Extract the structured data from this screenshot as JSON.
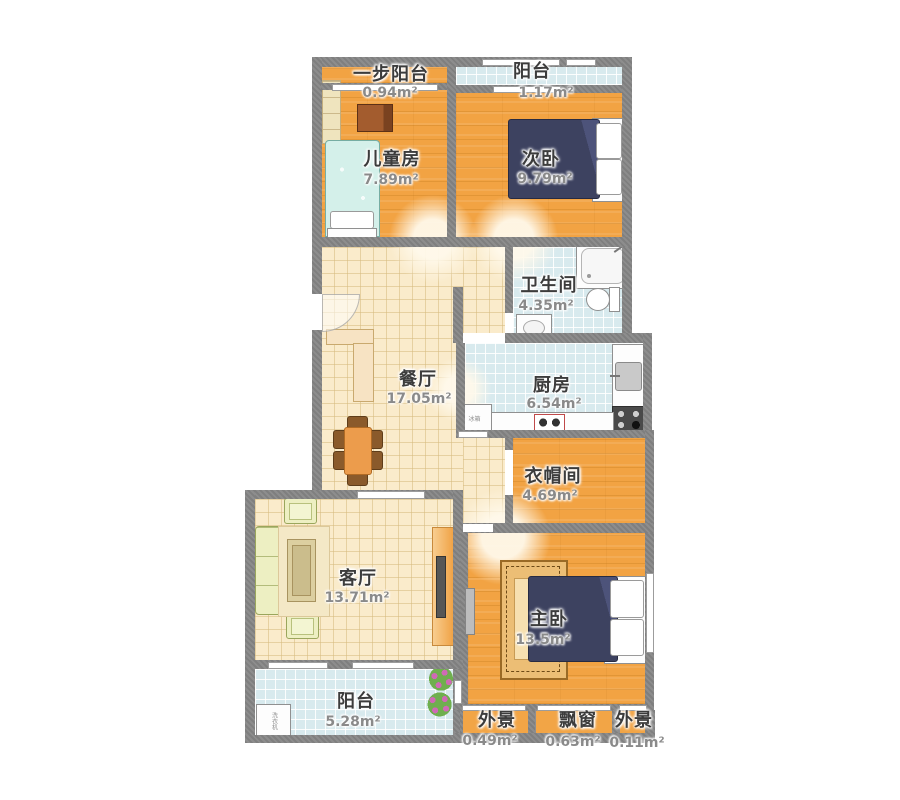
{
  "plan": {
    "rooms": [
      {
        "id": "one-step-balcony",
        "name": "一步阳台",
        "area": "0.94m²"
      },
      {
        "id": "balcony-top",
        "name": "阳台",
        "area": "1.17m²"
      },
      {
        "id": "kids-room",
        "name": "儿童房",
        "area": "7.89m²"
      },
      {
        "id": "second-bedroom",
        "name": "次卧",
        "area": "9.79m²"
      },
      {
        "id": "bathroom",
        "name": "卫生间",
        "area": "4.35m²"
      },
      {
        "id": "dining-room",
        "name": "餐厅",
        "area": "17.05m²"
      },
      {
        "id": "kitchen",
        "name": "厨房",
        "area": "6.54m²"
      },
      {
        "id": "cloakroom",
        "name": "衣帽间",
        "area": "4.69m²"
      },
      {
        "id": "living-room",
        "name": "客厅",
        "area": "13.71m²"
      },
      {
        "id": "master-bedroom",
        "name": "主卧",
        "area": "13.5m²"
      },
      {
        "id": "balcony-bottom",
        "name": "阳台",
        "area": "5.28m²"
      },
      {
        "id": "outer-view-left",
        "name": "外景",
        "area": "0.49m²"
      },
      {
        "id": "bay-window",
        "name": "飘窗",
        "area": "0.63m²"
      },
      {
        "id": "outer-view-right",
        "name": "外景",
        "area": "0.11m²"
      }
    ],
    "appliance_labels": {
      "washing_machine": "洗衣机",
      "fridge": "冰箱"
    },
    "colors": {
      "wall": "#8D8D8D",
      "wood_floor": "#F2A343",
      "cream_tile": "#FAEBCB",
      "blue_tile": "#D8EAEE",
      "bed_navy": "#3D4260",
      "sofa_green": "#EDEFC2"
    }
  }
}
